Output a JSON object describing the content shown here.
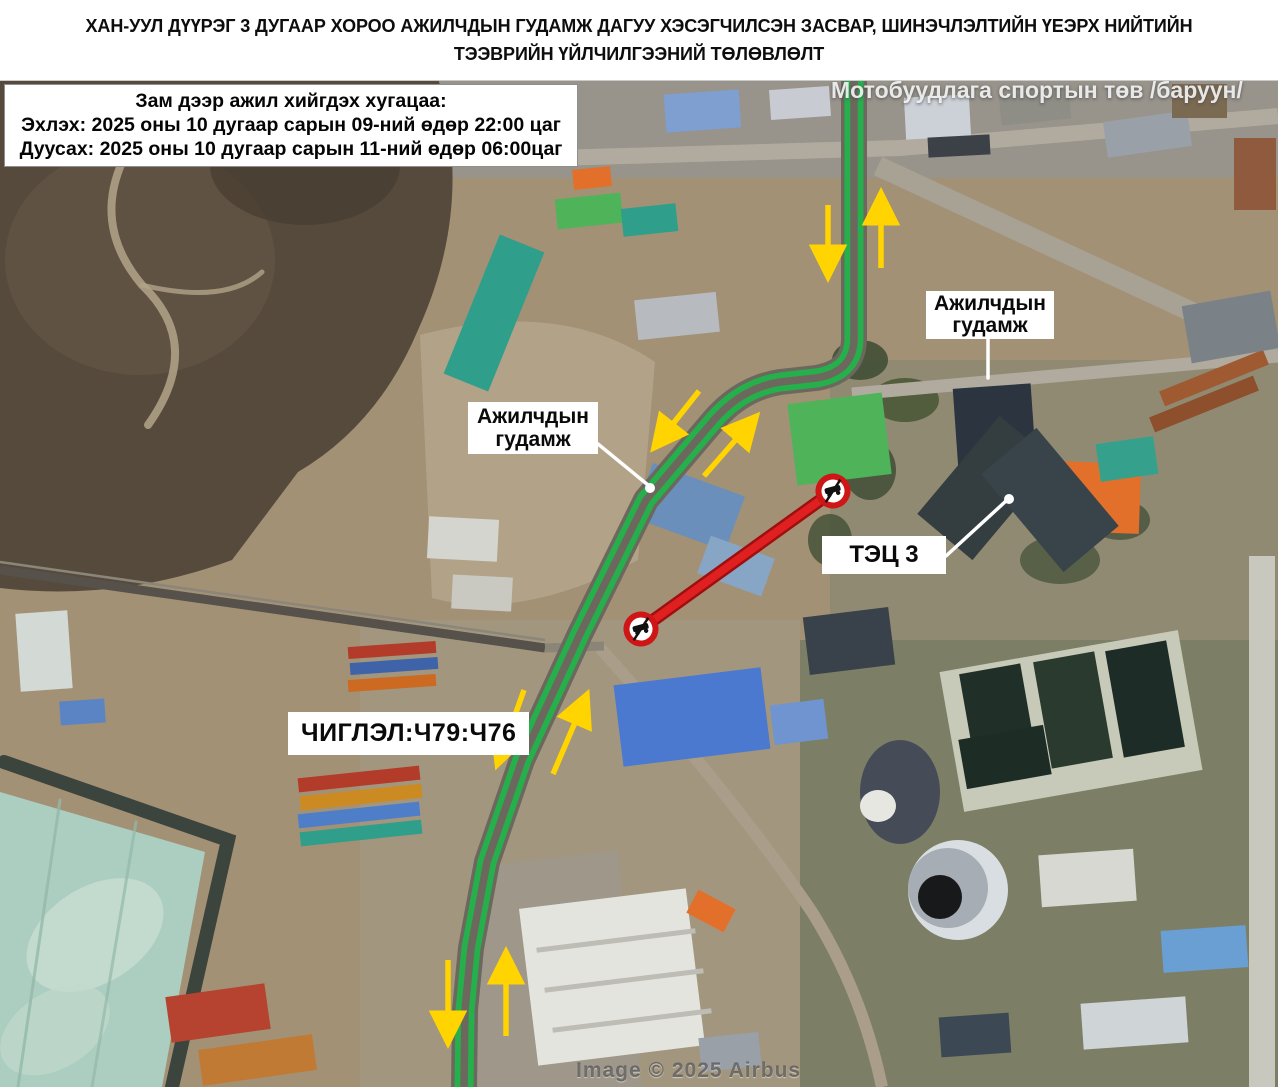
{
  "title": {
    "line1": "ХАН-УУЛ ДҮҮРЭГ 3 ДУГААР ХОРОО АЖИЛЧДЫН ГУДАМЖ ДАГУУ ХЭСЭГЧИЛСЭН ЗАСВАР, ШИНЭЧЛЭЛТИЙН ҮЕЭРХ НИЙТИЙН",
    "line2": "ТЭЭВРИЙН ҮЙЛЧИЛГЭЭНИЙ ТӨЛӨВЛӨЛТ"
  },
  "schedule_box": {
    "heading": "Зам дээр ажил хийгдэх хугацаа:",
    "start": "Эхлэх: 2025 оны 10 дугаар сарын 09-ний өдөр 22:00 цаг",
    "end": "Дуусах: 2025 оны 10 дугаар сарын 11-ний өдөр 06:00цаг"
  },
  "map_labels": {
    "street_label_right": {
      "line1": "Ажилчдын",
      "line2": "гудамж"
    },
    "street_label_center": {
      "line1": "Ажилчдын",
      "line2": "гудамж"
    },
    "power_plant": "ТЭЦ 3",
    "bus_routes": "ЧИГЛЭЛ:Ч79:Ч76",
    "poi_top_right": "Мотобуудлага спортын төв /баруун/"
  },
  "attribution": "Image © 2025 Airbus",
  "colors": {
    "detour_route_green": "#25b04c",
    "closed_road_red": "#e02020",
    "closed_road_casing": "#9e1010",
    "no_entry_ring_red": "#cf1616",
    "direction_arrow_yellow": "#ffd400",
    "label_box_bg": "#ffffff",
    "label_text": "#111111",
    "pointer_white": "#ffffff"
  },
  "map": {
    "base_color": "#a39176",
    "asphalt_color": "#6c685e",
    "route_path": "M 854 76 L 854 338 Q 854 372 816 378 L 780 382 Q 742 388 714 420 L 646 500 L 580 634 L 522 760 L 487 862 L 471 948 L 465 1010 L 464 1090",
    "closed_segment": [
      641,
      629,
      833,
      491
    ],
    "no_entry": [
      [
        641,
        629
      ],
      [
        833,
        491
      ]
    ],
    "arrows": [
      [
        828,
        205,
        828,
        272
      ],
      [
        881,
        268,
        881,
        198
      ],
      [
        699,
        391,
        657,
        444
      ],
      [
        704,
        476,
        753,
        420
      ],
      [
        524,
        690,
        499,
        760
      ],
      [
        553,
        774,
        585,
        699
      ],
      [
        448,
        960,
        448,
        1038
      ],
      [
        506,
        1036,
        506,
        957
      ]
    ],
    "pointers": [
      "M 988 336 L 988 378",
      "M 598 444 L 648 485",
      "M 946 556 L 1006 501"
    ],
    "pointer_dots": [
      [
        650,
        488
      ],
      [
        1009,
        499
      ]
    ],
    "terrain": [
      {
        "t": "rect",
        "x": 430,
        "y": 78,
        "w": 848,
        "h": 100,
        "fill": "#98938b"
      },
      {
        "t": "rect",
        "x": 830,
        "y": 360,
        "w": 448,
        "h": 330,
        "fill": "#8e8873",
        "op": 0.85
      },
      {
        "t": "rect",
        "x": 790,
        "y": 640,
        "w": 488,
        "h": 447,
        "fill": "#7c7f66"
      },
      {
        "t": "rect",
        "x": 360,
        "y": 620,
        "w": 440,
        "h": 467,
        "fill": "#a3967e"
      },
      {
        "t": "path",
        "d": "M 0 78 L 438 78 Q 475 205 418 330 Q 378 425 298 472 L 232 560 Q 118 602 0 588 Z",
        "fill": "#564a3c"
      },
      {
        "t": "ellipse",
        "cx": 140,
        "cy": 260,
        "rx": 135,
        "ry": 115,
        "fill": "#665846",
        "op": 0.6
      },
      {
        "t": "ellipse",
        "cx": 305,
        "cy": 165,
        "rx": 95,
        "ry": 60,
        "fill": "#483e32",
        "op": 0.75
      },
      {
        "t": "path",
        "d": "M 155 112 Q 75 205 142 285 Q 205 345 148 425",
        "stroke": "#b2a488",
        "sw": 8,
        "op": 0.85
      },
      {
        "t": "path",
        "d": "M 142 285 Q 225 305 262 272",
        "stroke": "#b2a488",
        "sw": 5,
        "op": 0.8
      },
      {
        "t": "path",
        "d": "M 420 335 Q 560 298 655 362 L 638 560 Q 520 622 432 598 Z",
        "fill": "#b4a489",
        "op": 0.9
      },
      {
        "t": "polygon",
        "pts": "470,868 618,850 642,1087 470,1087",
        "fill": "#9e978a"
      },
      {
        "t": "polygon",
        "pts": "0,792 205,852 162,1087 0,1087",
        "fill": "#abcec0"
      },
      {
        "t": "path",
        "d": "M 4 762 L 228 840 L 172 1087",
        "stroke": "#3b443d",
        "sw": 14
      },
      {
        "t": "ellipse",
        "cx": 95,
        "cy": 935,
        "rx": 75,
        "ry": 48,
        "rot": -32,
        "fill": "#c9dfd3",
        "op": 0.75
      },
      {
        "t": "ellipse",
        "cx": 55,
        "cy": 1030,
        "rx": 60,
        "ry": 38,
        "rot": -32,
        "fill": "#c2dacd",
        "op": 0.7
      },
      {
        "t": "path",
        "d": "M 60 800 L 18 1087",
        "stroke": "#93b9a9",
        "sw": 3,
        "op": 0.8
      },
      {
        "t": "path",
        "d": "M 136 822 L 92 1087",
        "stroke": "#93b9a9",
        "sw": 3,
        "op": 0.7
      },
      {
        "t": "rect",
        "x": 950,
        "y": 650,
        "w": 242,
        "h": 142,
        "rot": -10,
        "fill": "#c7cab8"
      },
      {
        "t": "rect",
        "x": 968,
        "y": 668,
        "w": 62,
        "h": 108,
        "rot": -10,
        "fill": "#202f28"
      },
      {
        "t": "rect",
        "x": 1042,
        "y": 656,
        "w": 62,
        "h": 108,
        "rot": -10,
        "fill": "#2a3a2e"
      },
      {
        "t": "rect",
        "x": 1114,
        "y": 645,
        "w": 62,
        "h": 108,
        "rot": -10,
        "fill": "#1d2c26"
      },
      {
        "t": "rect",
        "x": 962,
        "y": 732,
        "w": 86,
        "h": 50,
        "rot": -10,
        "fill": "#1e2c26"
      },
      {
        "t": "ellipse",
        "cx": 860,
        "cy": 360,
        "rx": 28,
        "ry": 20,
        "fill": "#3c4a33",
        "op": 0.85
      },
      {
        "t": "ellipse",
        "cx": 905,
        "cy": 400,
        "rx": 34,
        "ry": 22,
        "fill": "#42512f",
        "op": 0.8
      },
      {
        "t": "ellipse",
        "cx": 870,
        "cy": 470,
        "rx": 26,
        "ry": 30,
        "fill": "#3c4a33",
        "op": 0.8
      },
      {
        "t": "ellipse",
        "cx": 1060,
        "cy": 560,
        "rx": 40,
        "ry": 24,
        "fill": "#45533a",
        "op": 0.75
      },
      {
        "t": "ellipse",
        "cx": 1120,
        "cy": 520,
        "rx": 30,
        "ry": 20,
        "fill": "#3c4a33",
        "op": 0.7
      },
      {
        "t": "ellipse",
        "cx": 830,
        "cy": 540,
        "rx": 22,
        "ry": 26,
        "fill": "#404f36",
        "op": 0.8
      },
      {
        "t": "ellipse",
        "cx": 900,
        "cy": 792,
        "rx": 40,
        "ry": 52,
        "fill": "#454c58"
      },
      {
        "t": "ellipse",
        "cx": 878,
        "cy": 806,
        "rx": 18,
        "ry": 16,
        "fill": "#e7e7e1"
      },
      {
        "t": "ellipse",
        "cx": 958,
        "cy": 890,
        "rx": 50,
        "ry": 50,
        "fill": "#d9dee2"
      },
      {
        "t": "ellipse",
        "cx": 948,
        "cy": 888,
        "rx": 40,
        "ry": 40,
        "fill": "#a6adb5"
      },
      {
        "t": "ellipse",
        "cx": 940,
        "cy": 897,
        "rx": 22,
        "ry": 22,
        "fill": "#18191b"
      }
    ],
    "roads": [
      {
        "d": "M 556 158 L 900 148 L 1278 116",
        "w": 16,
        "c": "#b1ab9f"
      },
      {
        "d": "M 878 166 L 1278 352",
        "w": 20,
        "c": "#a8a295"
      },
      {
        "d": "M 852 394 L 1278 356",
        "w": 13,
        "c": "#b1ab9f"
      },
      {
        "d": "M 1262 556 L 1262 1087",
        "w": 26,
        "c": "#c8c8bf"
      },
      {
        "d": "M 600 648 Q 730 792 812 912 Q 862 992 882 1087",
        "w": 12,
        "c": "#aa9e8b"
      },
      {
        "d": "M 0 570 L 545 648",
        "w": 9,
        "c": "#56524b"
      },
      {
        "d": "M 0 562 L 545 640",
        "w": 2.5,
        "c": "#8b867a"
      },
      {
        "d": "M 545 648 L 604 646",
        "w": 9,
        "c": "#8a8577"
      }
    ],
    "buildings": [
      [
        665,
        92,
        75,
        38,
        -4,
        "#7f9fd0"
      ],
      [
        770,
        88,
        60,
        30,
        -4,
        "#c8ccd2"
      ],
      [
        905,
        96,
        65,
        42,
        -3,
        "#ccd1d7"
      ],
      [
        1000,
        92,
        70,
        30,
        -6,
        "#8e8e86"
      ],
      [
        1105,
        116,
        85,
        36,
        -8,
        "#99a0a8"
      ],
      [
        1172,
        84,
        55,
        34,
        0,
        "#7b6a52"
      ],
      [
        1234,
        138,
        42,
        72,
        0,
        "#8f5a3e"
      ],
      [
        928,
        136,
        62,
        20,
        -3,
        "#3c4148"
      ],
      [
        470,
        238,
        48,
        150,
        22,
        "#2f9e8a"
      ],
      [
        556,
        196,
        66,
        30,
        -6,
        "#4fb35a"
      ],
      [
        573,
        168,
        38,
        20,
        -6,
        "#e2702b"
      ],
      [
        622,
        206,
        55,
        28,
        -6,
        "#2f9e8a"
      ],
      [
        636,
        296,
        82,
        40,
        -6,
        "#b7bbc0"
      ],
      [
        792,
        398,
        95,
        82,
        -7,
        "#4fb35a"
      ],
      [
        956,
        386,
        78,
        96,
        -4,
        "#2c3440"
      ],
      [
        1028,
        462,
        112,
        70,
        2,
        "#e2702b"
      ],
      [
        640,
        478,
        98,
        58,
        20,
        "#6a8fba"
      ],
      [
        702,
        546,
        68,
        40,
        20,
        "#87a6c6"
      ],
      [
        428,
        518,
        70,
        42,
        3,
        "#d5d5cf"
      ],
      [
        452,
        576,
        60,
        34,
        3,
        "#c9c9c2"
      ],
      [
        18,
        612,
        52,
        78,
        -4,
        "#d3d9d5"
      ],
      [
        60,
        700,
        45,
        24,
        -4,
        "#5b84c4"
      ],
      [
        348,
        644,
        88,
        12,
        -4,
        "#b23b2a"
      ],
      [
        350,
        660,
        88,
        12,
        -4,
        "#3f63a8"
      ],
      [
        348,
        677,
        88,
        12,
        -4,
        "#cc6a22"
      ],
      [
        298,
        772,
        122,
        14,
        -6,
        "#b23b2a"
      ],
      [
        300,
        790,
        122,
        14,
        -6,
        "#cc8a22"
      ],
      [
        298,
        808,
        122,
        14,
        -6,
        "#4f7ec9"
      ],
      [
        300,
        826,
        122,
        14,
        -6,
        "#2f9e8a"
      ],
      [
        168,
        990,
        100,
        46,
        -8,
        "#b5432f"
      ],
      [
        200,
        1042,
        115,
        36,
        -8,
        "#c07a33"
      ],
      [
        528,
        898,
        168,
        158,
        -7,
        "#e4e4de"
      ],
      [
        536,
        938,
        160,
        5,
        -7,
        "#bdbdb5"
      ],
      [
        544,
        978,
        160,
        5,
        -7,
        "#bdbdb5"
      ],
      [
        552,
        1018,
        160,
        5,
        -7,
        "#bdbdb5"
      ],
      [
        690,
        898,
        42,
        26,
        28,
        "#e2702b"
      ],
      [
        618,
        676,
        148,
        82,
        -7,
        "#4a79cf"
      ],
      [
        772,
        702,
        54,
        40,
        -7,
        "#6f94cf"
      ],
      [
        806,
        612,
        86,
        58,
        -7,
        "#39414b"
      ],
      [
        950,
        424,
        72,
        128,
        40,
        "#343e40"
      ],
      [
        1014,
        436,
        72,
        128,
        -40,
        "#39444a"
      ],
      [
        1098,
        440,
        58,
        38,
        -8,
        "#35a08c"
      ],
      [
        1158,
        370,
        112,
        16,
        -22,
        "#a05a32"
      ],
      [
        1148,
        396,
        112,
        16,
        -22,
        "#8d4f2c"
      ],
      [
        1186,
        298,
        90,
        58,
        -10,
        "#7a8288"
      ],
      [
        1040,
        852,
        95,
        52,
        -4,
        "#d8d8d2"
      ],
      [
        1162,
        928,
        85,
        42,
        -4,
        "#6a9fd4"
      ],
      [
        1082,
        1000,
        105,
        46,
        -4,
        "#cfd4d7"
      ],
      [
        940,
        1015,
        70,
        40,
        -4,
        "#3d4855"
      ],
      [
        700,
        1035,
        60,
        34,
        -6,
        "#9aa0a8"
      ]
    ]
  }
}
